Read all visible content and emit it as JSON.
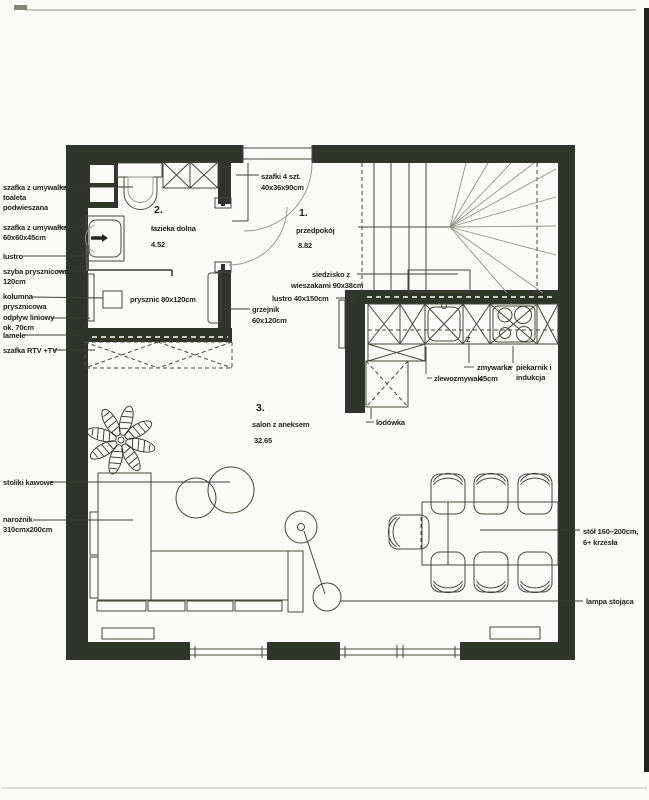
{
  "colors": {
    "wall": "#30352b",
    "paper": "#fbfbf9",
    "ink": "#22221e",
    "furniture_line": "#47473f",
    "stair_line": "#92928b"
  },
  "left_labels": [
    {
      "lines": [
        "szafka z umywalką",
        "toaleta",
        "podwieszana"
      ]
    },
    {
      "lines": [
        "szafka z umywalką",
        "60x60x45cm"
      ]
    },
    {
      "lines": [
        "lustro"
      ]
    },
    {
      "lines": [
        "szyba prysznicowa",
        "120cm"
      ]
    },
    {
      "lines": [
        "kolumna",
        "prysznicowa",
        "odpływ liniowy",
        "ok. 70cm"
      ]
    },
    {
      "lines": [
        "lamele"
      ]
    },
    {
      "lines": [
        "szafka RTV +TV"
      ]
    },
    {
      "lines": [
        "stoliki kawowe"
      ]
    },
    {
      "lines": [
        "narożnik",
        "310cmx200cm"
      ]
    }
  ],
  "right_labels": [
    {
      "lines": [
        "stół 160–200cm,",
        "6+ krzesła"
      ]
    },
    {
      "lines": [
        "lampa stojąca"
      ]
    }
  ],
  "rooms": [
    {
      "number": "2.",
      "name": "łazieka dolna",
      "area": "4.52"
    },
    {
      "number": "1.",
      "name": "przedpokój",
      "area": "8.82"
    },
    {
      "number": "3.",
      "name": "salon z aneksem",
      "area": "32.65"
    }
  ],
  "annotations": {
    "cabinets_line1": "szafki 4 szt.",
    "cabinets_line2": "40x36x90cm",
    "bench_line1": "siedzisko z",
    "bench_line2": "wieszakami 90x38cm",
    "mirror_hall": "lustro 40x150cm",
    "radiator_line1": "grzejnik",
    "radiator_line2": "60x120cm",
    "shower": "prysznic 80x120cm",
    "dishwasher": "zmywarka",
    "dishwasher_size": "45cm",
    "sink_kitchen": "zlewozmywak",
    "oven_line1": "piekarnik i",
    "oven_line2": "indukcja",
    "fridge": "lodówka",
    "z_mark": "Z"
  }
}
